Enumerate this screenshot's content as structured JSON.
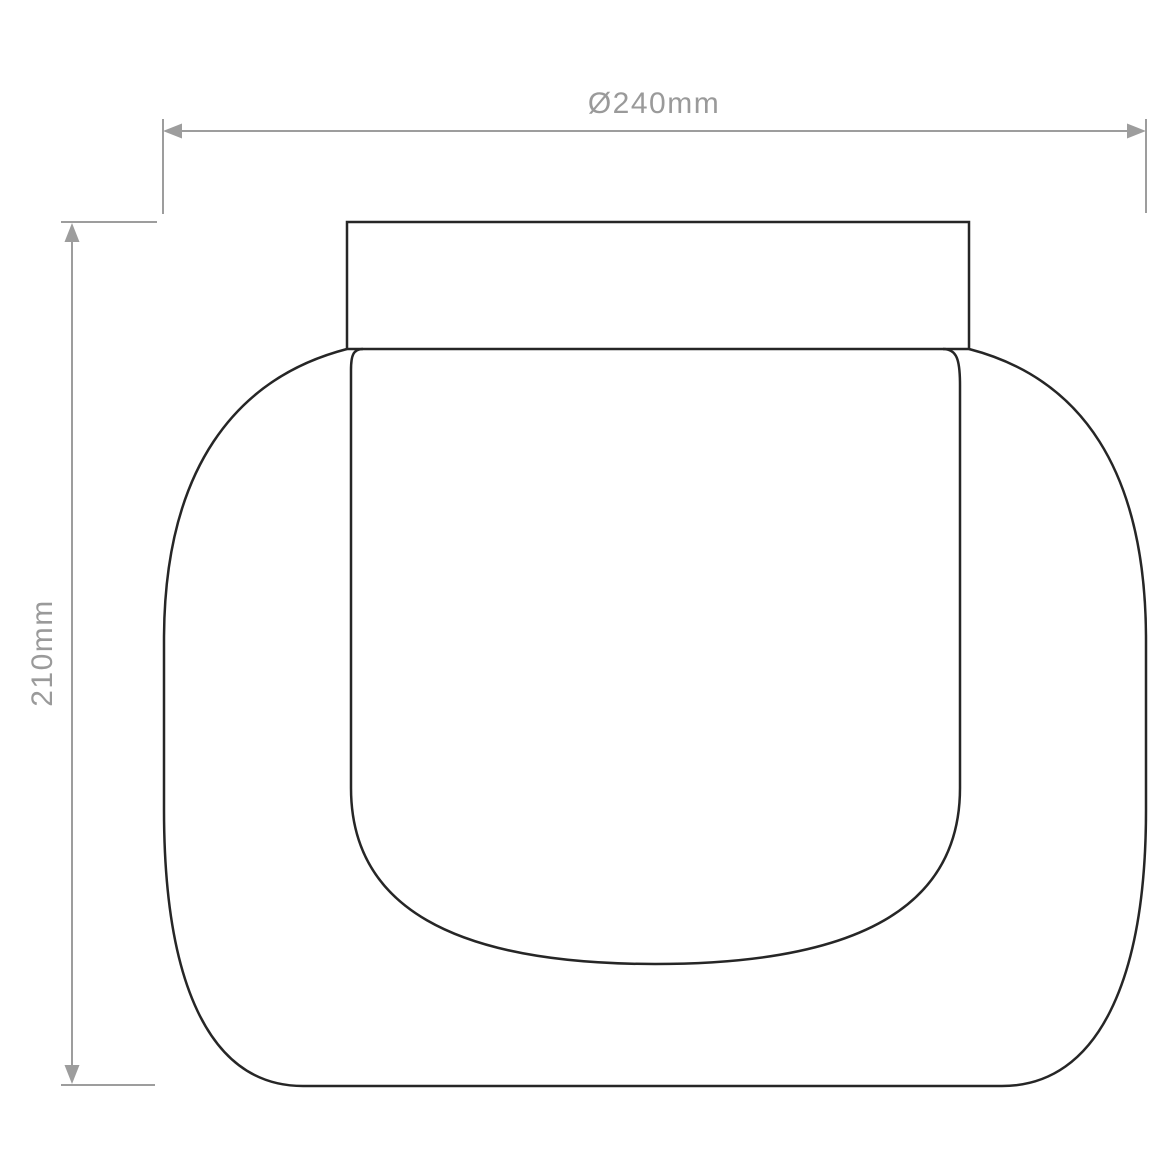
{
  "diagram": {
    "type": "technical-dimension-drawing",
    "dimensions": {
      "width": {
        "label": "Ø240mm"
      },
      "height": {
        "label": "210mm"
      }
    }
  },
  "colors": {
    "outline": "#262626",
    "dimension": "#9d9d9d",
    "label": "#9a9a9a",
    "background": "#ffffff"
  }
}
